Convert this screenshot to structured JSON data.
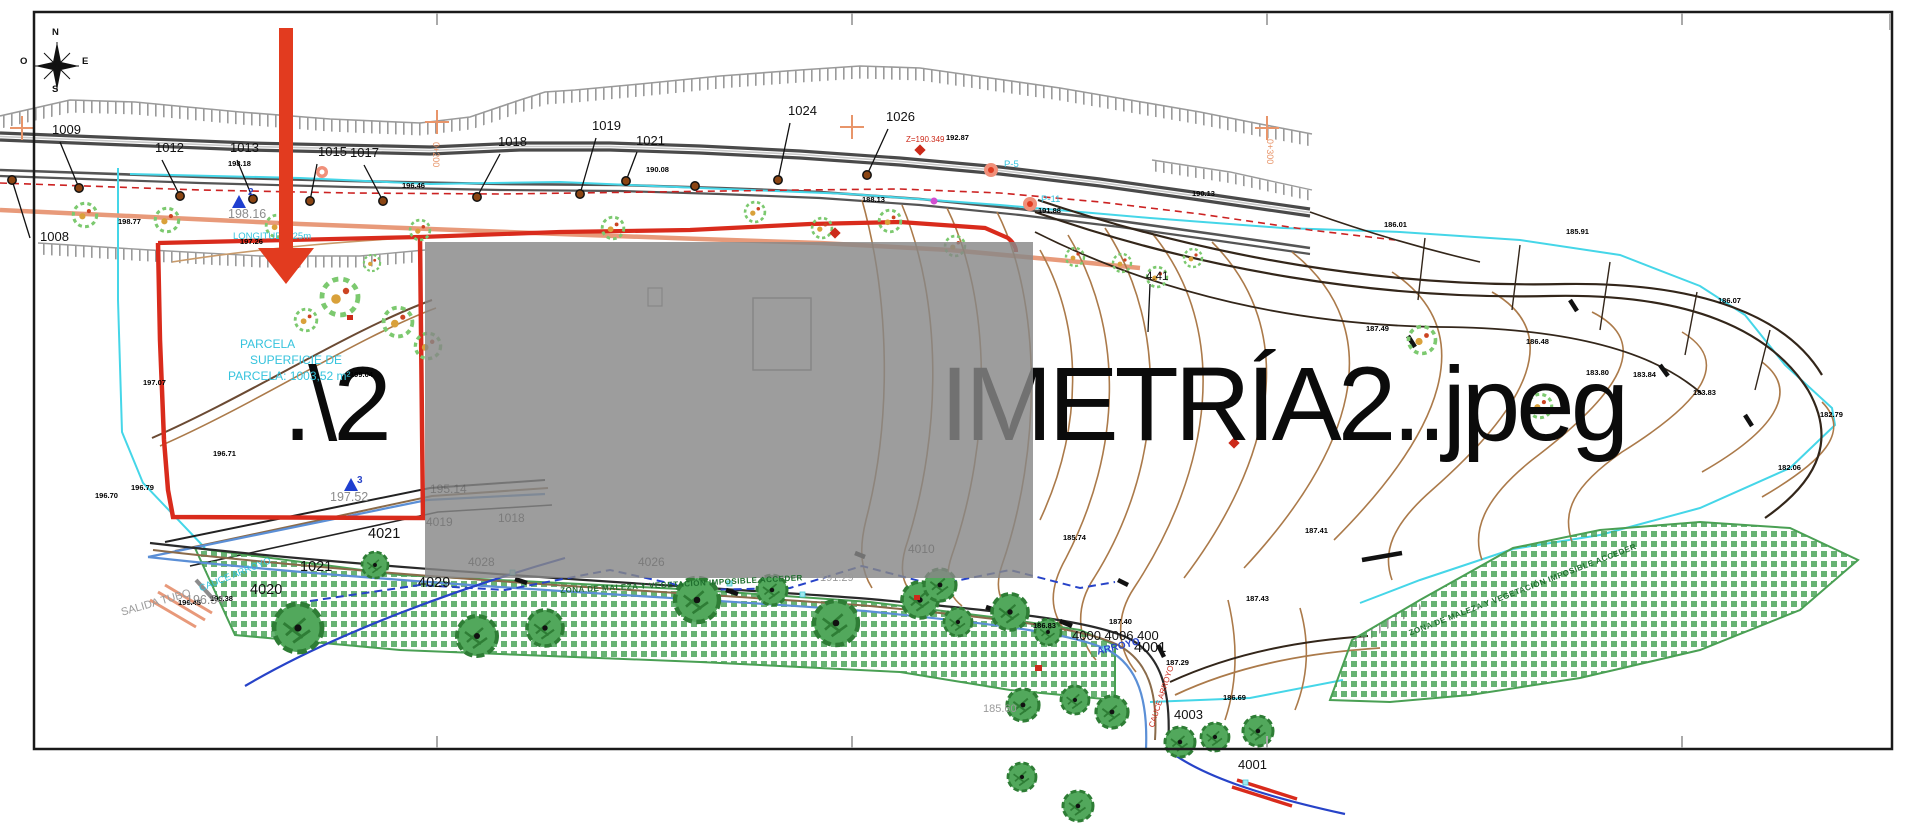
{
  "watermark": {
    "left": ".\\2",
    "right": "IMETRÍA2..jpeg"
  },
  "colors": {
    "boundary_red": "#d92b1c",
    "survey_cyan": "#45d6e8",
    "contour_brown": "#ab7a4a",
    "vegetation_green": "#4ea65c",
    "stream_blue": "#2743c8",
    "overlay_gray": "rgba(135,135,135,0.82)",
    "arrow_red": "#e23b1f",
    "road_gray": "#4a4a4a"
  },
  "map": {
    "labels": [
      {
        "t": "N",
        "x": 52,
        "y": 28,
        "c": "cp"
      },
      {
        "t": "O",
        "x": 20,
        "y": 57,
        "c": "cp"
      },
      {
        "t": "E",
        "x": 82,
        "y": 57,
        "c": "cp"
      },
      {
        "t": "S",
        "x": 52,
        "y": 85,
        "c": "cp"
      },
      {
        "t": "1008",
        "x": 40,
        "y": 230,
        "c": "st"
      },
      {
        "t": "1009",
        "x": 52,
        "y": 123,
        "c": "st"
      },
      {
        "t": "1012",
        "x": 155,
        "y": 141,
        "c": "st"
      },
      {
        "t": "1013",
        "x": 230,
        "y": 141,
        "c": "st"
      },
      {
        "t": "1015",
        "x": 318,
        "y": 145,
        "c": "st"
      },
      {
        "t": "1017",
        "x": 350,
        "y": 146,
        "c": "st"
      },
      {
        "t": "1018",
        "x": 498,
        "y": 135,
        "c": "st"
      },
      {
        "t": "1019",
        "x": 592,
        "y": 119,
        "c": "st"
      },
      {
        "t": "1021",
        "x": 636,
        "y": 134,
        "c": "st"
      },
      {
        "t": "1024",
        "x": 788,
        "y": 104,
        "c": "st"
      },
      {
        "t": "1026",
        "x": 886,
        "y": 110,
        "c": "st"
      },
      {
        "t": "4.41",
        "x": 1146,
        "y": 272,
        "c": "med"
      },
      {
        "t": "1021",
        "x": 300,
        "y": 560,
        "c": "st2"
      },
      {
        "t": "4021",
        "x": 368,
        "y": 527,
        "c": "st2"
      },
      {
        "t": "4020",
        "x": 250,
        "y": 583,
        "c": "st2"
      },
      {
        "t": "4029",
        "x": 418,
        "y": 576,
        "c": "st2"
      },
      {
        "t": "4000 4006 400",
        "x": 1072,
        "y": 629,
        "c": "st"
      },
      {
        "t": "4001",
        "x": 1134,
        "y": 641,
        "c": "st2"
      },
      {
        "t": "4003",
        "x": 1174,
        "y": 708,
        "c": "st"
      },
      {
        "t": "4001",
        "x": 1238,
        "y": 758,
        "c": "st"
      },
      {
        "t": "198.77",
        "x": 118,
        "y": 218,
        "c": "el"
      },
      {
        "t": "198.18",
        "x": 228,
        "y": 160,
        "c": "el"
      },
      {
        "t": "196.46",
        "x": 402,
        "y": 182,
        "c": "el"
      },
      {
        "t": "190.08",
        "x": 646,
        "y": 166,
        "c": "el"
      },
      {
        "t": "188.13",
        "x": 862,
        "y": 196,
        "c": "el"
      },
      {
        "t": "192.87",
        "x": 946,
        "y": 134,
        "c": "el"
      },
      {
        "t": "191.88",
        "x": 1038,
        "y": 207,
        "c": "el"
      },
      {
        "t": "190.13",
        "x": 1192,
        "y": 190,
        "c": "el"
      },
      {
        "t": "186.01",
        "x": 1384,
        "y": 221,
        "c": "el"
      },
      {
        "t": "185.91",
        "x": 1566,
        "y": 228,
        "c": "el"
      },
      {
        "t": "186.07",
        "x": 1718,
        "y": 297,
        "c": "el"
      },
      {
        "t": "187.49",
        "x": 1366,
        "y": 325,
        "c": "el"
      },
      {
        "t": "186.48",
        "x": 1526,
        "y": 338,
        "c": "el"
      },
      {
        "t": "183.80",
        "x": 1586,
        "y": 369,
        "c": "el"
      },
      {
        "t": "183.84",
        "x": 1633,
        "y": 371,
        "c": "el"
      },
      {
        "t": "183.83",
        "x": 1693,
        "y": 389,
        "c": "el"
      },
      {
        "t": "182.06",
        "x": 1778,
        "y": 464,
        "c": "el"
      },
      {
        "t": "182.79",
        "x": 1820,
        "y": 411,
        "c": "el"
      },
      {
        "t": "185.74",
        "x": 1063,
        "y": 534,
        "c": "el"
      },
      {
        "t": "187.41",
        "x": 1305,
        "y": 527,
        "c": "el"
      },
      {
        "t": "187.43",
        "x": 1246,
        "y": 595,
        "c": "el"
      },
      {
        "t": "187.40",
        "x": 1109,
        "y": 618,
        "c": "el"
      },
      {
        "t": "187.29",
        "x": 1166,
        "y": 659,
        "c": "el"
      },
      {
        "t": "186.83",
        "x": 1033,
        "y": 622,
        "c": "el"
      },
      {
        "t": "186.69",
        "x": 1223,
        "y": 694,
        "c": "el"
      },
      {
        "t": "196.45",
        "x": 178,
        "y": 599,
        "c": "el"
      },
      {
        "t": "196.38",
        "x": 210,
        "y": 595,
        "c": "el"
      },
      {
        "t": "196.79",
        "x": 131,
        "y": 484,
        "c": "el"
      },
      {
        "t": "197.26",
        "x": 240,
        "y": 238,
        "c": "el"
      },
      {
        "t": "197.07",
        "x": 143,
        "y": 379,
        "c": "el"
      },
      {
        "t": "196.71",
        "x": 213,
        "y": 450,
        "c": "el"
      },
      {
        "t": "196.70",
        "x": 95,
        "y": 492,
        "c": "el"
      },
      {
        "t": "199.04",
        "x": 350,
        "y": 371,
        "c": "el"
      },
      {
        "t": "198.16",
        "x": 228,
        "y": 208,
        "c": "gr"
      },
      {
        "t": "197.52",
        "x": 330,
        "y": 491,
        "c": "gr"
      },
      {
        "t": "196.54",
        "x": 186,
        "y": 594,
        "c": "gr"
      },
      {
        "t": "191.29",
        "x": 820,
        "y": 573,
        "c": "gr2"
      },
      {
        "t": "185.60",
        "x": 983,
        "y": 704,
        "c": "gr2"
      },
      {
        "t": "PARCELA",
        "x": 240,
        "y": 338,
        "c": "cy"
      },
      {
        "t": "SUPERFICIE DE",
        "x": 250,
        "y": 354,
        "c": "cy"
      },
      {
        "t": "PARCELA: 1003,52 m²",
        "x": 228,
        "y": 370,
        "c": "cy"
      },
      {
        "t": "LONGITUD 4.25m",
        "x": 233,
        "y": 232,
        "c": "cys"
      },
      {
        "t": "P-5",
        "x": 1004,
        "y": 160,
        "c": "cys"
      },
      {
        "t": "P-11",
        "x": 1041,
        "y": 195,
        "c": "cys"
      },
      {
        "t": "CAUCE ARROYO",
        "x": 198,
        "y": 585,
        "c": "cys",
        "r": -22
      },
      {
        "t": "SALIDA TUBO",
        "x": 120,
        "y": 608,
        "c": "gr2",
        "r": -16
      },
      {
        "t": "ARROYO",
        "x": 1096,
        "y": 648,
        "c": "bl",
        "r": -14
      },
      {
        "t": "3",
        "x": 357,
        "y": 476,
        "c": "bl"
      },
      {
        "t": "2",
        "x": 248,
        "y": 188,
        "c": "bl"
      },
      {
        "t": "CAUCE ARROYO",
        "x": 1148,
        "y": 726,
        "c": "rd",
        "r": -72
      },
      {
        "t": "Z=190.349",
        "x": 906,
        "y": 136,
        "c": "rd"
      },
      {
        "t": "0+200",
        "x": 440,
        "y": 142,
        "c": "or",
        "r": 90
      },
      {
        "t": "0+300",
        "x": 1274,
        "y": 139,
        "c": "or",
        "r": 90
      },
      {
        "t": "ZONA DE MALEZA Y VEGETACIÓN IMPOSIBLE ACCEDER",
        "x": 560,
        "y": 587,
        "c": "gn",
        "r": -3
      },
      {
        "t": "ZONA DE MALEZA Y VEGETACIÓN IMPOSIBLE ACCEDER",
        "x": 1408,
        "y": 630,
        "c": "gn",
        "r": -21
      },
      {
        "t": "4019",
        "x": 426,
        "y": 516,
        "c": "fa"
      },
      {
        "t": "1018",
        "x": 498,
        "y": 512,
        "c": "fa"
      },
      {
        "t": "4028",
        "x": 468,
        "y": 556,
        "c": "fa"
      },
      {
        "t": "4026",
        "x": 638,
        "y": 556,
        "c": "fa"
      },
      {
        "t": "4010",
        "x": 908,
        "y": 543,
        "c": "fa"
      },
      {
        "t": "195.14",
        "x": 430,
        "y": 483,
        "c": "fa"
      }
    ]
  }
}
